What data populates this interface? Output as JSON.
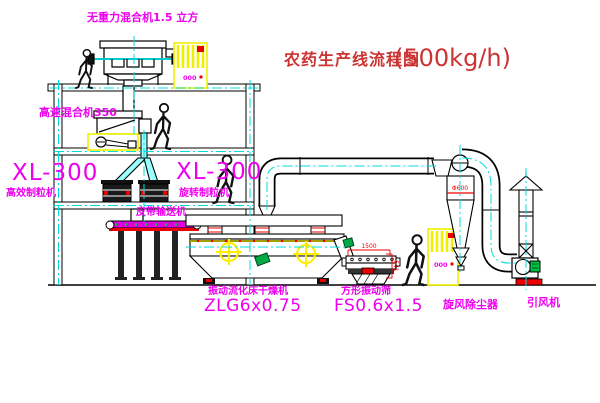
{
  "title": {
    "text": "农药生产线流程图",
    "capacity": "(500kg/h)"
  },
  "equipment_labels": {
    "gravity_mixer": "无重力混合机1.5 立方",
    "high_speed_mixer": "高速混合机350",
    "granulator_left_model": "XL-300",
    "granulator_left_name": "高效制粒机",
    "granulator_mid_model": "XL-300",
    "granulator_mid_name": "旋转制粒机",
    "belt_conveyor": "皮带输送机",
    "dryer_name": "振动流化床干燥机",
    "dryer_model": "ZLG6x0.75",
    "sieve_name": "方形振动筛",
    "sieve_model": "FS0.6x1.5",
    "cyclone": "旋风除尘器",
    "fan": "引风机"
  },
  "dimensions": {
    "sieve_length": "1500",
    "sieve_height": "541",
    "cyclone_diameter": "Φ600"
  },
  "control_panels": {
    "panel1_display": "000",
    "panel2_display": "000"
  },
  "colors": {
    "label_magenta": "#ee00ee",
    "title_red": "#cc3333",
    "centerline_cyan": "#00dddd",
    "highlight_yellow": "#f0f000",
    "accent_red": "#ee0000",
    "motor_green": "#00aa44"
  }
}
